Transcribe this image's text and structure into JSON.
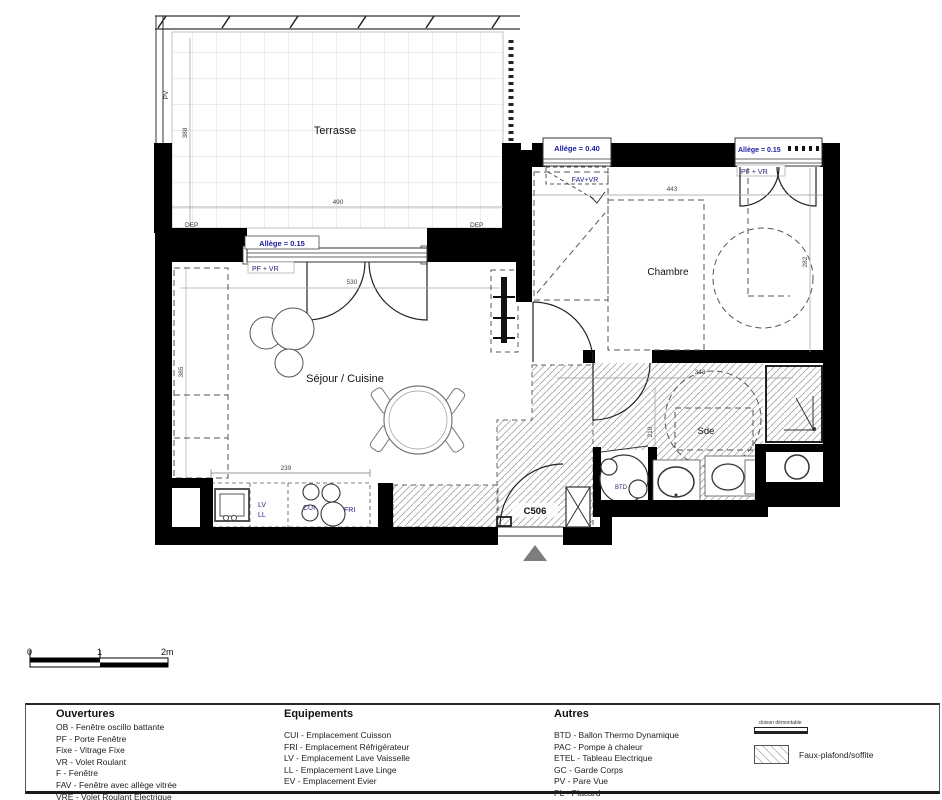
{
  "plan": {
    "rooms": {
      "terrasse": "Terrasse",
      "sejour": "Séjour / Cuisine",
      "chambre": "Chambre",
      "sde": "Sde"
    },
    "unit": "C506",
    "windows": {
      "sejour_allege": "Allège = 0.15",
      "sejour_type": "PF + VR",
      "chambre_left_allege": "Allége = 0.40",
      "chambre_left_type": "FAV+VR",
      "chambre_right_allege": "Allège = 0.15",
      "chambre_right_type": "PF + VR"
    },
    "equip": {
      "lv": "LV",
      "ll": "LL",
      "cui": "CUI",
      "fri": "FRI",
      "btd": "BTD"
    },
    "misc": {
      "pv": "PV",
      "dep": "DEP"
    },
    "dims": {
      "terrasse_w": "490",
      "terrasse_d": "388",
      "sejour_w": "530",
      "sejour_d": "385",
      "kitchen_w": "239",
      "chambre_w": "443",
      "chambre_d": "282",
      "sde_w": "343",
      "sde_d": "210"
    }
  },
  "scale": {
    "t0": "0",
    "t1": "1",
    "t2": "2m"
  },
  "legend": {
    "ouvertures": {
      "title": "Ouvertures",
      "items": [
        "OB - Fenêtre oscillo battante",
        "PF - Porte Fenêtre",
        "Fixe - Vitrage Fixe",
        "VR - Volet Roulant",
        "F - Fenêtre",
        "FAV - Fenêtre avec allège vitrée",
        "VRE - Volet Roulant Electrique"
      ]
    },
    "equipements": {
      "title": "Equipements",
      "items": [
        "CUI - Emplacement Cuisson",
        "FRI - Emplacement Réfrigérateur",
        "LV - Emplacement Lave Vaisselle",
        "LL - Emplacement Lave Linge",
        "EV - Emplacement Evier"
      ]
    },
    "autres": {
      "title": "Autres",
      "items": [
        "BTD - Ballon Thermo Dynamique",
        "PAC - Pompe à chaleur",
        "ETEL - Tableau Electrique",
        "GC - Garde Corps",
        "PV - Pare Vue",
        "PL - Placard"
      ]
    },
    "symbols": {
      "cloison": "cloison démontable",
      "faux_plafond": "Faux-plafond/soffite"
    }
  },
  "colors": {
    "blue": "#1b1ba0",
    "navy": "#24247e",
    "wall": "#000000",
    "hatch": "#a8a8a8",
    "triangle": "#7d7d7d"
  }
}
